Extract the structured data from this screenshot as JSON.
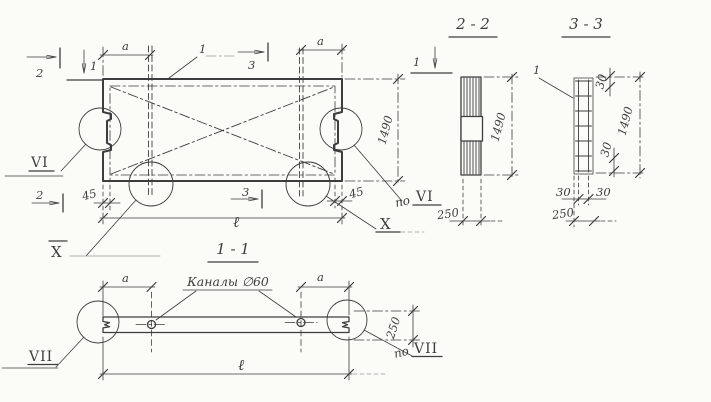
{
  "drawing": {
    "ink_color": "#3d3d3d",
    "construction_color": "#9a9a9a",
    "background": "#fbfbf8"
  },
  "plan": {
    "section_mark_1": "1",
    "section_mark_2": "2",
    "section_mark_3": "3",
    "rebar_callout": "1",
    "dim_a": "a",
    "dim_height": "1490",
    "dim_length": "ℓ",
    "dim_edge_offset": "45",
    "detail_vi": "VI",
    "detail_x": "X",
    "prefix_po": "по"
  },
  "section_2_2": {
    "title": "2 - 2",
    "dim_height": "1490",
    "dim_thickness": "250"
  },
  "section_3_3": {
    "title": "3 - 3",
    "rebar_callout": "1",
    "dim_height": "1490",
    "dim_thickness": "250",
    "dim_cover": "30"
  },
  "section_1_1": {
    "title": "1 - 1",
    "dim_a": "a",
    "dim_length": "ℓ",
    "dim_thickness": "250",
    "channels_label": "Каналы ∅60",
    "prefix_po": "по",
    "detail_vii": "VII"
  }
}
